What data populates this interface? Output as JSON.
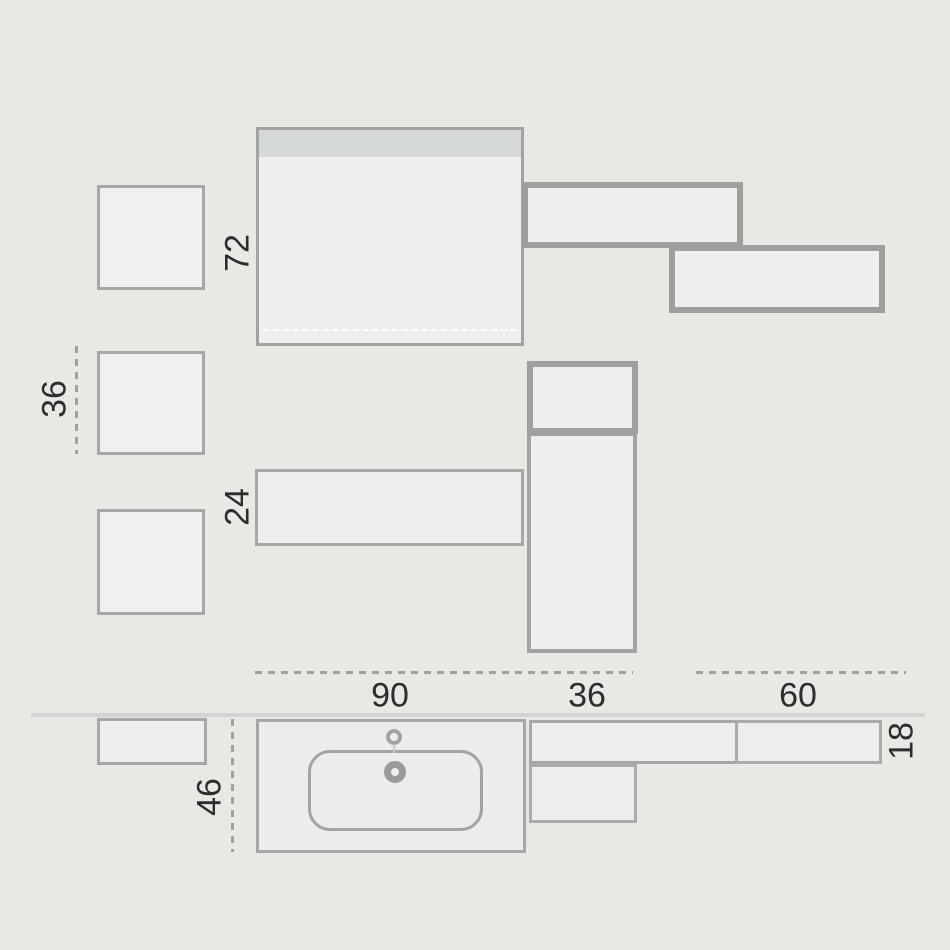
{
  "palette": {
    "background": "#eae8e5",
    "outline": "#a7a7a5",
    "outline_thick": "#9f9f9d",
    "panel_fill": "#efeeec",
    "top_strip": "#d4d8d8",
    "wall_line": "#d3d3d1",
    "dash": "#a0a09e",
    "text": "#2d2d2d"
  },
  "labels": {
    "elevation": {
      "main_unit_height": "72",
      "side_box_size": "36",
      "low_unit_height": "24"
    },
    "widths": {
      "vanity": "90",
      "column": "36",
      "wall_cabinet": "60"
    },
    "plan": {
      "vanity_depth": "46",
      "wall_depth": "18"
    }
  }
}
